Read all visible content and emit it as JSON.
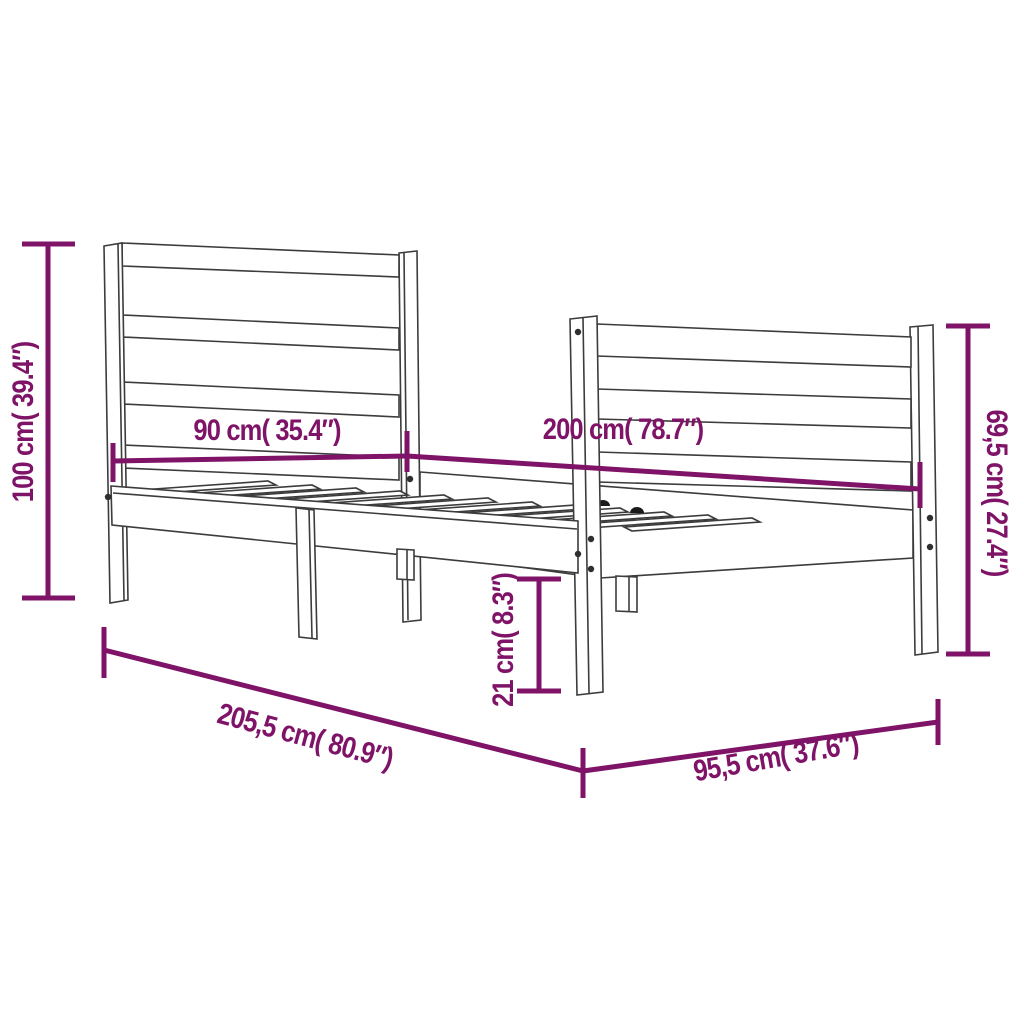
{
  "colors": {
    "accent": "#7f1367",
    "line_art": "#3c3c3c",
    "background": "#ffffff"
  },
  "diagram_type": "bed-frame dimension drawing",
  "dimensions": {
    "headboard_height": {
      "label": "100 cm( 39.4″)",
      "value_cm": "100",
      "value_inch": "39.4"
    },
    "headboard_width": {
      "label": "90 cm( 35.4″)",
      "value_cm": "90",
      "value_inch": "35.4"
    },
    "bed_length": {
      "label": "200 cm( 78.7″)",
      "value_cm": "200",
      "value_inch": "78.7"
    },
    "footboard_height": {
      "label": "69,5 cm( 27.4″)",
      "value_cm": "69,5",
      "value_inch": "27.4"
    },
    "rail_height": {
      "label": "21 cm( 8.3″)",
      "value_cm": "21",
      "value_inch": "8.3"
    },
    "frame_length": {
      "label": "205,5 cm( 80.9″)",
      "value_cm": "205,5",
      "value_inch": "80.9"
    },
    "frame_width": {
      "label": "95,5 cm( 37.6″)",
      "value_cm": "95,5",
      "value_inch": "37.6"
    }
  }
}
